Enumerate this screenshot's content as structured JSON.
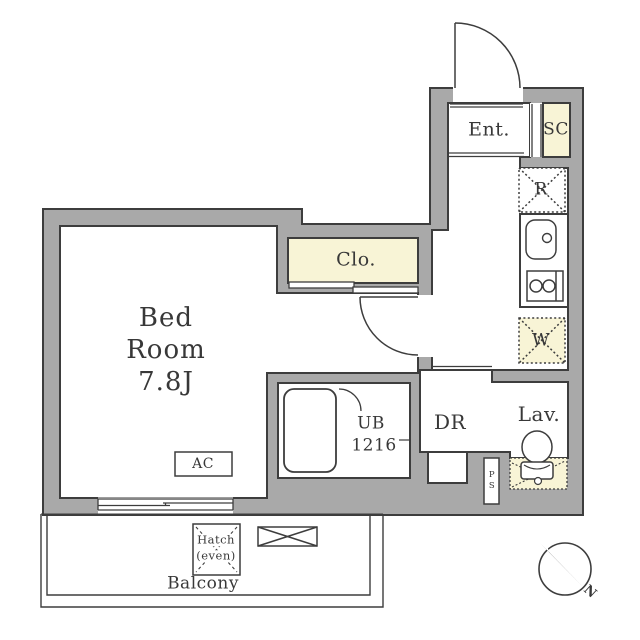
{
  "floorplan": {
    "title": "apartment-floor-plan",
    "rooms": {
      "entrance": "Ent.",
      "shoe_closet": "SC",
      "refrigerator": "R",
      "washer": "W",
      "closet": "Clo.",
      "bedroom_line1": "Bed",
      "bedroom_line2": "Room",
      "bedroom_line3": "7.8J",
      "unit_bath_line1": "UB",
      "unit_bath_line2": "1216",
      "dressing_room": "DR",
      "lavatory": "Lav.",
      "pipe_space": "PS",
      "air_conditioner": "AC",
      "hatch_line1": "Hatch",
      "hatch_line2": "(even)",
      "balcony": "Balcony",
      "compass_north": "N"
    },
    "colors": {
      "wall_gray": "#a9a9a9",
      "line_dark": "#3d3d3d",
      "accent_cream": "#f8f4d6",
      "floor_white": "#ffffff"
    }
  }
}
